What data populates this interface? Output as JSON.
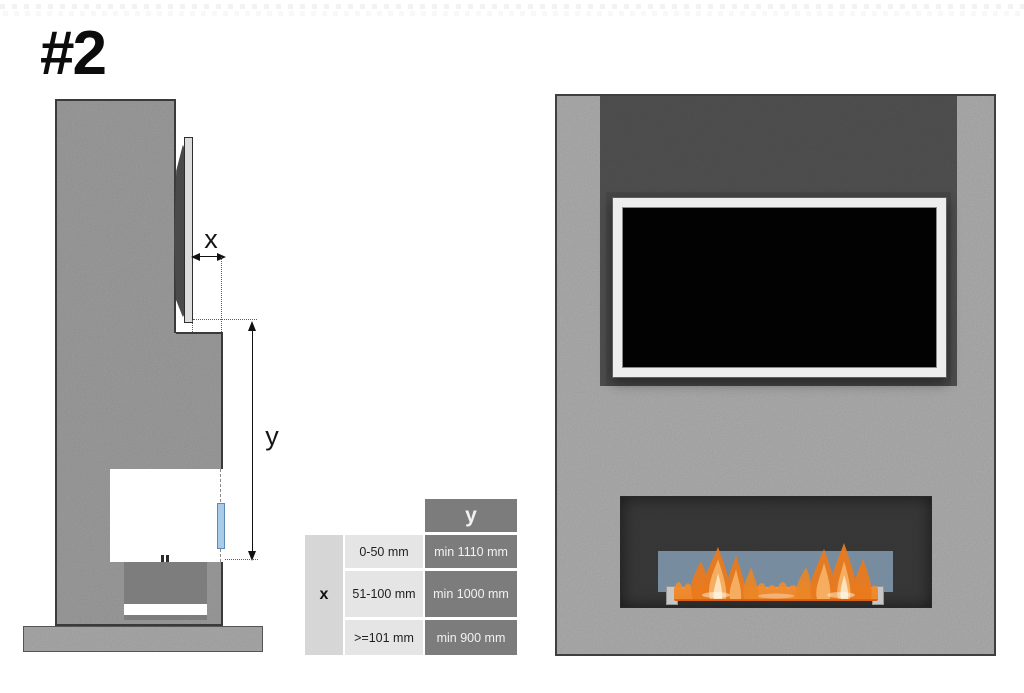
{
  "title": "#2",
  "side_view": {
    "x_label": "x",
    "y_label": "y"
  },
  "table": {
    "x_header": "x",
    "y_header": "y",
    "rows": [
      {
        "range": "0-50 mm",
        "min_y": "min 1110 mm"
      },
      {
        "range": "51-100 mm",
        "min_y": "min 1000 mm"
      },
      {
        "range": ">=101 mm",
        "min_y": "min 900 mm"
      }
    ]
  },
  "colors": {
    "side_wall": "#a5a5a5",
    "front_wall": "#b6b6b6",
    "tv_niche": "#565656",
    "fire_opening": "#3d3d3d",
    "firebox_side": "#7d7d7d",
    "base_plinth": "#b3b3b3",
    "glass_blue": "#8298af",
    "flame_orange": "#e87a1e",
    "table_dark_cell": "#7c7c7c",
    "table_light_cell": "#e5e5e5"
  }
}
